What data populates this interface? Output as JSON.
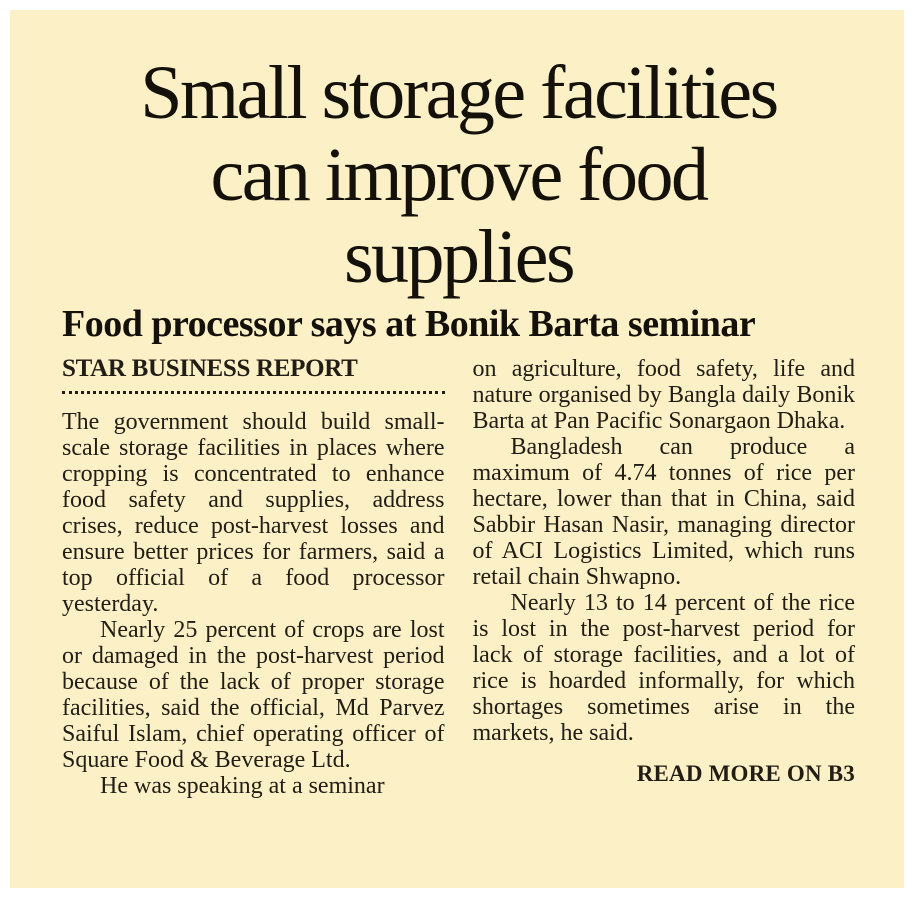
{
  "article": {
    "headline_lines": {
      "line1": "Small storage facilities",
      "line2": "can improve food",
      "line3": "supplies"
    },
    "subheadline": "Food processor says at Bonik Barta seminar",
    "byline": "STAR BUSINESS REPORT",
    "columns": {
      "left": {
        "p1": "The government should build small-scale storage facilities in places where cropping is concentrated to enhance food safety and supplies, address crises, reduce post-harvest losses and ensure better prices for farmers, said a top official of a food processor yesterday.",
        "p2": "Nearly 25 percent of crops are lost or damaged in the post-harvest period because of the lack of proper storage facilities, said the official, Md Parvez Saiful Islam, chief operating officer of Square Food & Beverage Ltd.",
        "p3": "He was speaking at a seminar"
      },
      "right": {
        "p1": "on agriculture, food safety, life and nature organised by Bangla daily Bonik Barta at Pan Pacific Sonargaon Dhaka.",
        "p2": "Bangladesh can produce a maximum of 4.74 tonnes of rice per hectare, lower than that in China, said Sabbir Hasan Nasir, managing director of ACI Logistics Limited, which runs retail chain Shwapno.",
        "p3": "Nearly 13 to 14 percent of the rice is lost in the post-harvest period for lack of storage facilities, and a lot of rice is hoarded informally, for which shortages sometimes arise in the markets, he said."
      }
    },
    "read_more": "READ MORE ON B3"
  },
  "colors": {
    "margin_background": "#ffffff",
    "paper_background": "#fbf0c6",
    "text": "#221d15",
    "headline_text": "#14100a"
  }
}
